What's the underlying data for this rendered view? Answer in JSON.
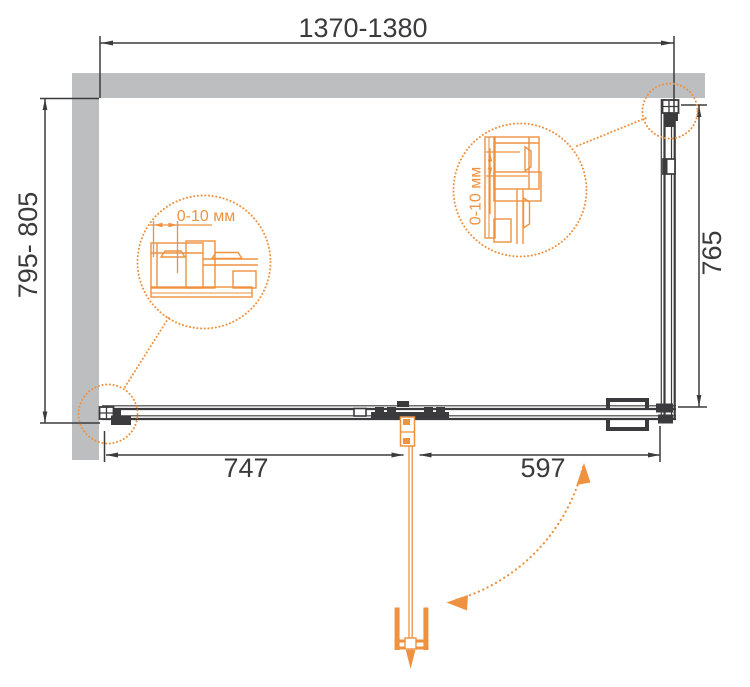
{
  "diagram": {
    "dimensions": {
      "top_width": "1370-1380",
      "left_depth": "795- 805",
      "right_depth": "765",
      "bottom_fixed_width": "747",
      "bottom_door_width": "597"
    },
    "details": {
      "left_adjustment_label": "0-10 мм",
      "right_adjustment_label": "0-10 мм"
    },
    "colors": {
      "accent": "#EE9240",
      "line": "#3B3B3D",
      "wall": "#BCBEC0",
      "background": "#FFFFFF"
    }
  }
}
